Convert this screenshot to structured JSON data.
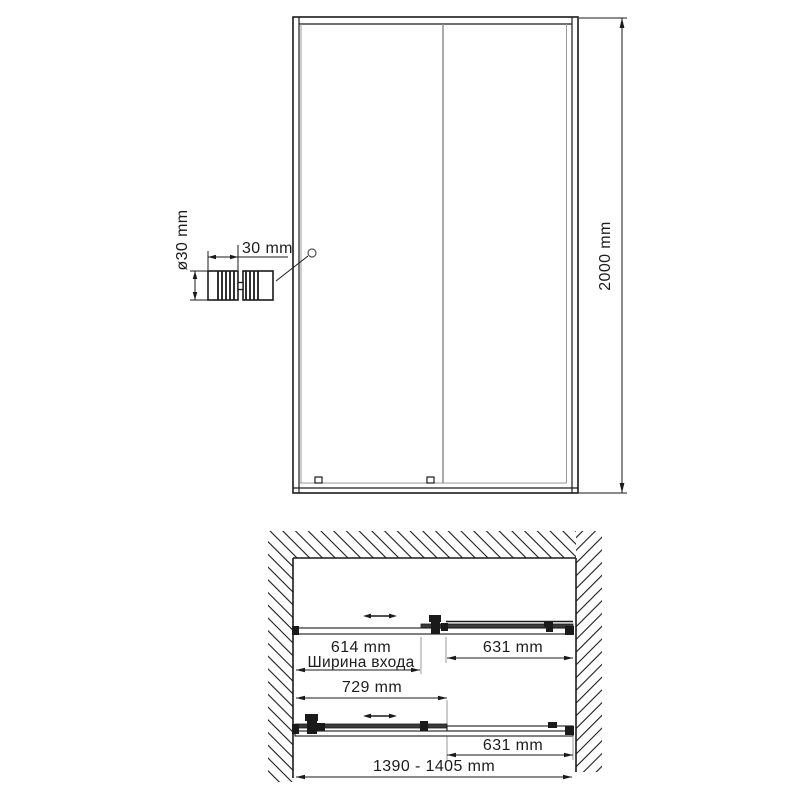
{
  "front_view": {
    "height_dim": "2000 mm",
    "handle_detail": {
      "width_dim": "30 mm",
      "diameter_dim": "ø30 mm"
    }
  },
  "plan_view": {
    "open": {
      "entrance_dim": "614 mm",
      "entrance_caption": "Ширина входа",
      "fixed_panel_dim": "631 mm"
    },
    "closed": {
      "sliding_panel_dim": "729 mm",
      "fixed_panel_dim": "631 mm"
    },
    "overall_dim": "1390 - 1405 mm"
  },
  "colors": {
    "line": "#1a1a1a",
    "glass_line": "#989898",
    "background": "#ffffff"
  }
}
